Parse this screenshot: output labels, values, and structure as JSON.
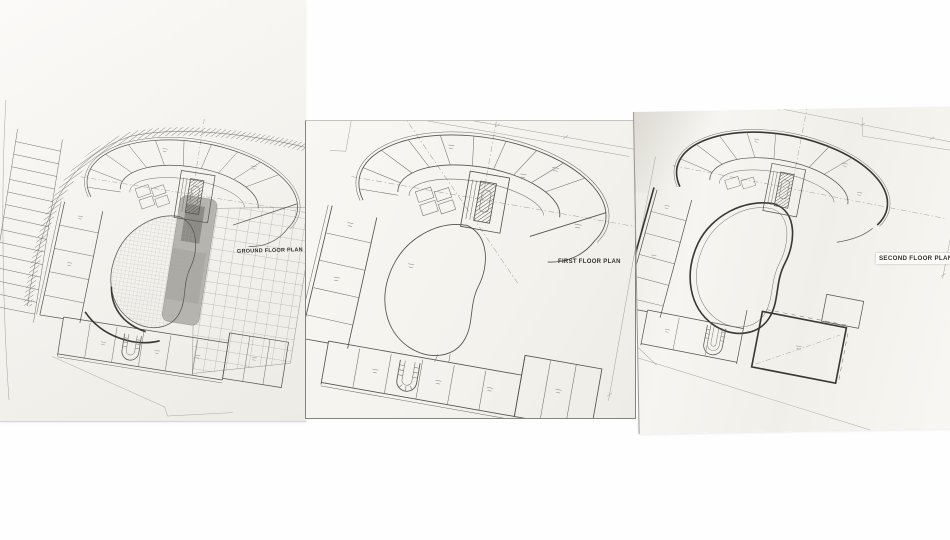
{
  "panels": [
    {
      "title": "GROUND FLOOR PLAN"
    },
    {
      "title": "FIRST FLOOR PLAN"
    },
    {
      "title": "SECOND FLOOR PLAN"
    }
  ],
  "colors": {
    "background": "#ffffff",
    "paper_light": "#f8f7f3",
    "paper_shaded": "#edebe5",
    "drawing_ink": "#55534e",
    "heavy_ink": "#3a3834",
    "shaded_core_gray": "#b6b4ae",
    "label_ink": "#33312c"
  }
}
